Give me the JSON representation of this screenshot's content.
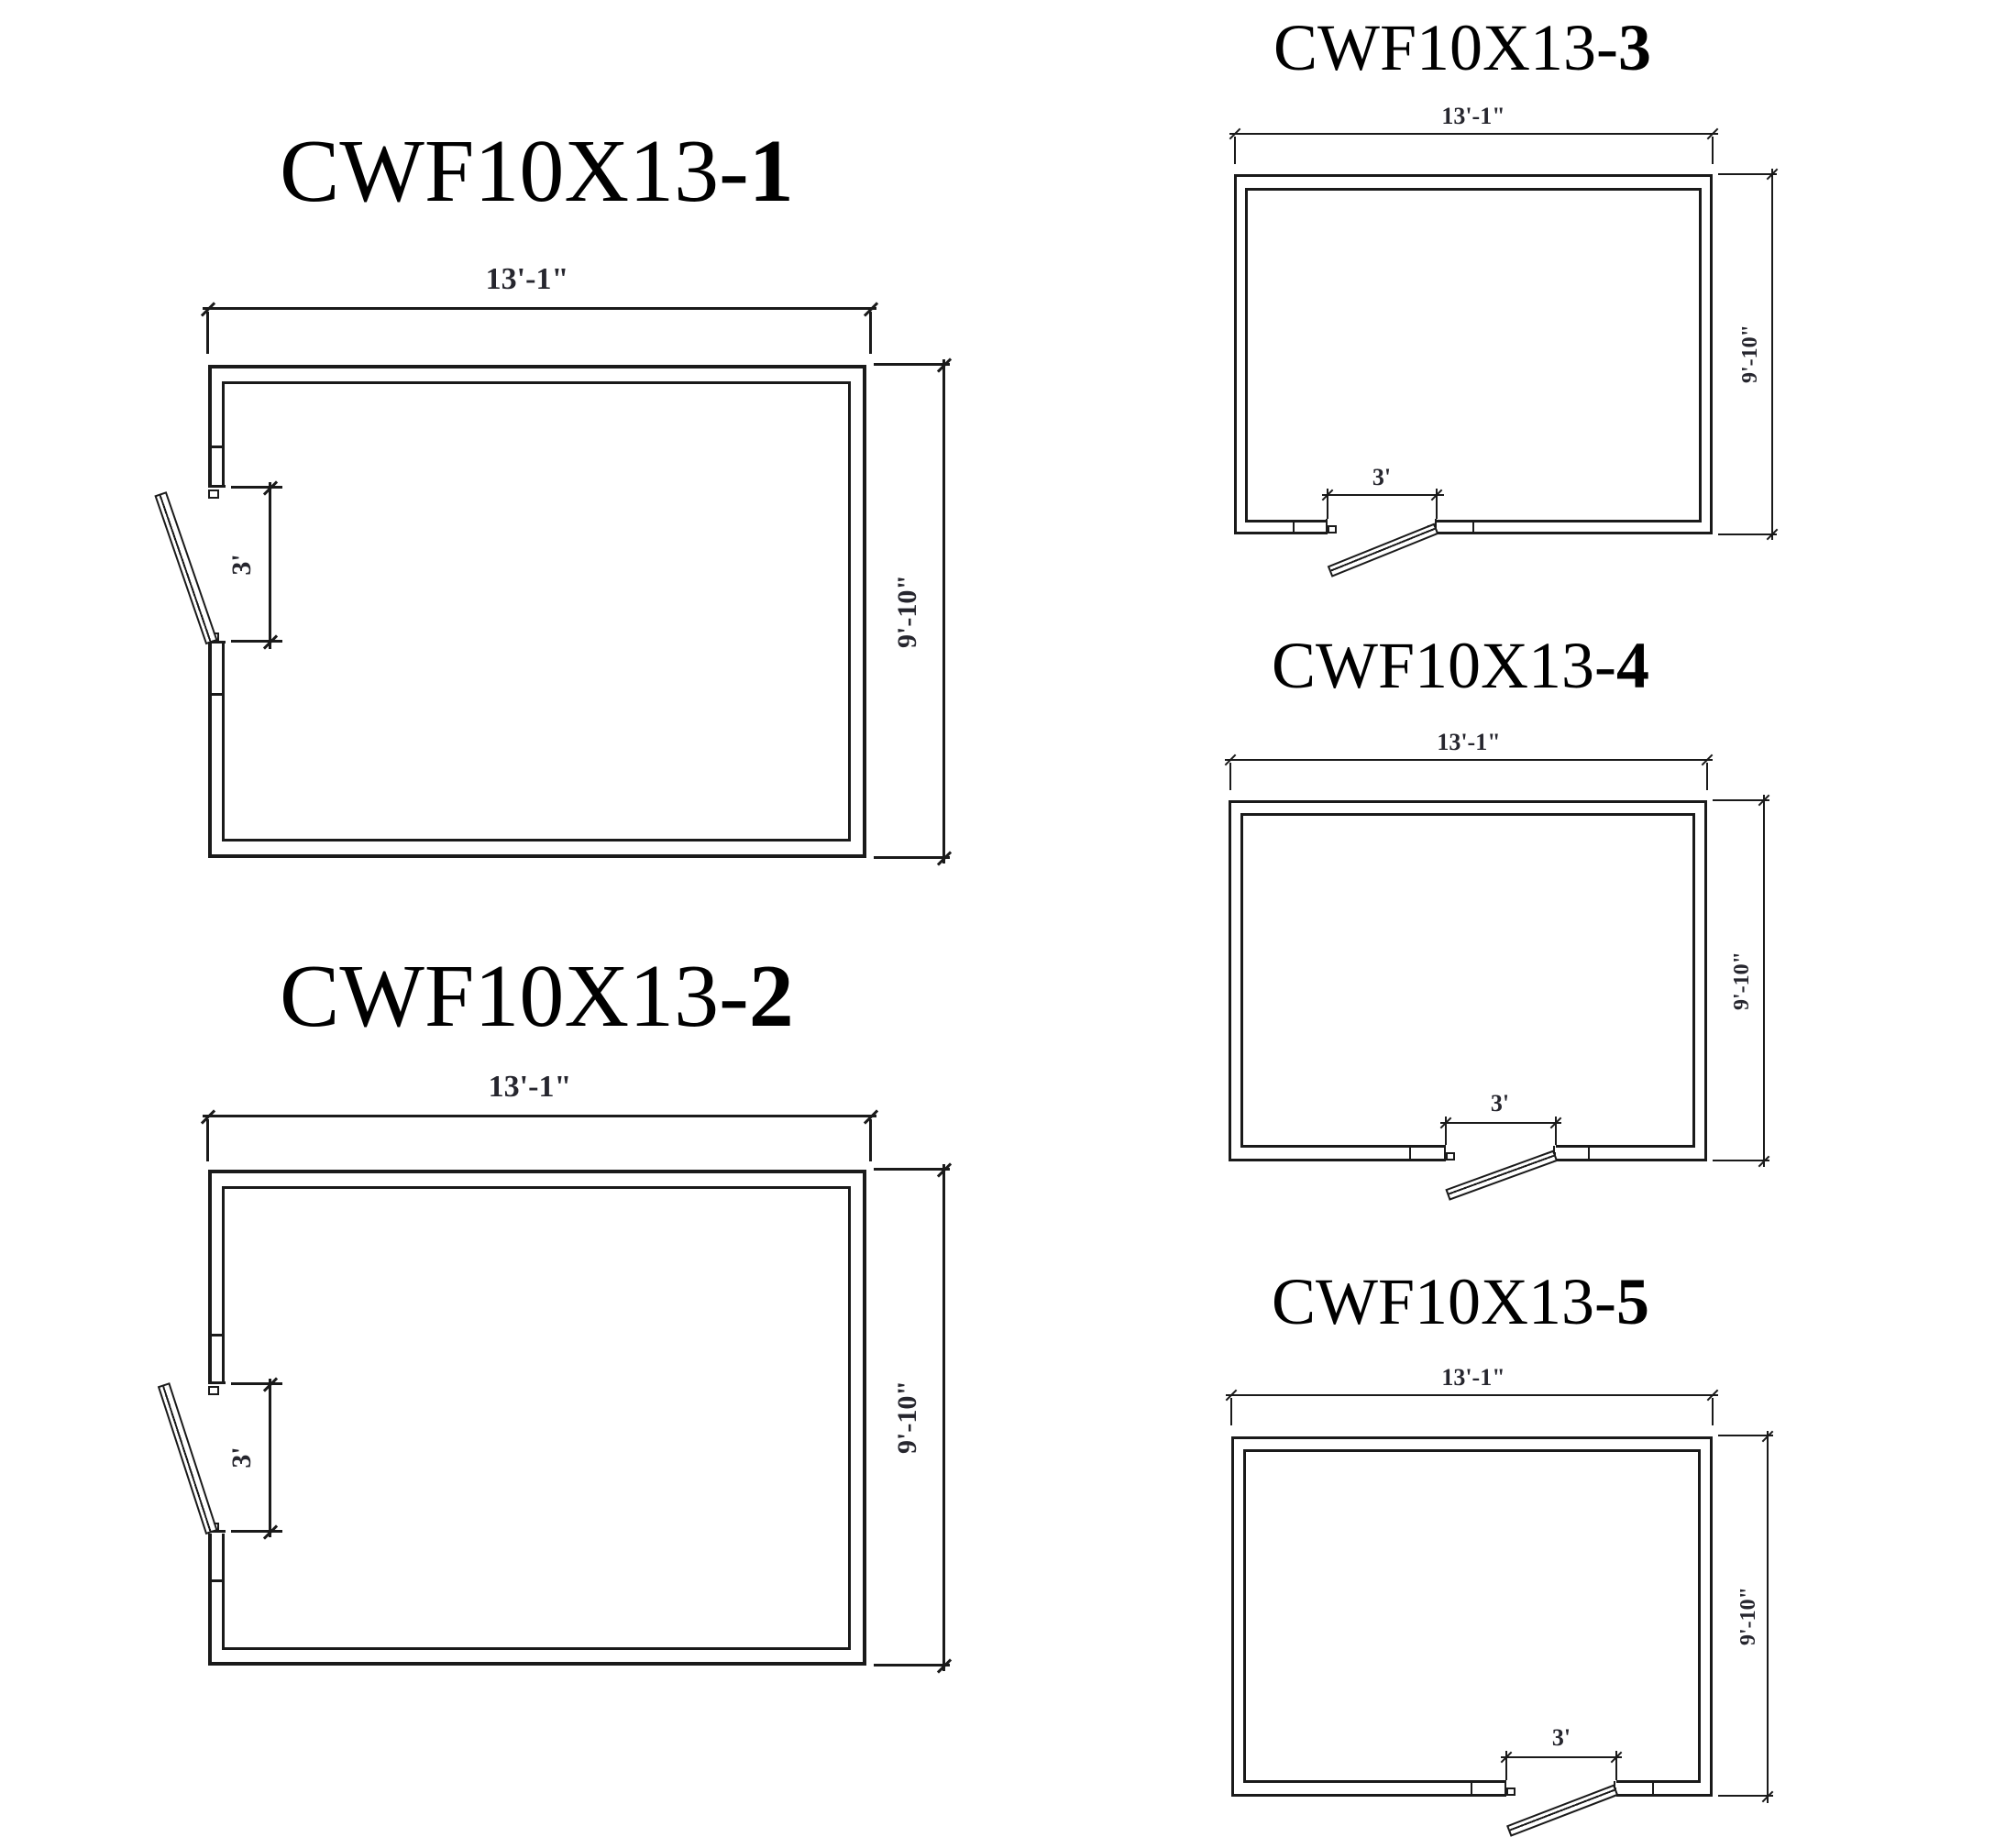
{
  "sheet": {
    "background": "#ffffff",
    "line_color": "#1a1a1a",
    "drawing_type": "walk-in cooler/freezer floor plans"
  },
  "plans": [
    {
      "title_prefix": "CWF10X13-",
      "title_suffix": "1",
      "width_label": "13'-1\"",
      "height_label": "9'-10\"",
      "door_label": "3'",
      "door_wall": "left"
    },
    {
      "title_prefix": "CWF10X13-",
      "title_suffix": "2",
      "width_label": "13'-1\"",
      "height_label": "9'-10\"",
      "door_label": "3'",
      "door_wall": "left"
    },
    {
      "title_prefix": "CWF10X13-",
      "title_suffix": "3",
      "width_label": "13'-1\"",
      "height_label": "9'-10\"",
      "door_label": "3'",
      "door_wall": "bottom"
    },
    {
      "title_prefix": "CWF10X13-",
      "title_suffix": "4",
      "width_label": "13'-1\"",
      "height_label": "9'-10\"",
      "door_label": "3'",
      "door_wall": "bottom"
    },
    {
      "title_prefix": "CWF10X13-",
      "title_suffix": "5",
      "width_label": "13'-1\"",
      "height_label": "9'-10\"",
      "door_label": "3'",
      "door_wall": "bottom"
    }
  ]
}
